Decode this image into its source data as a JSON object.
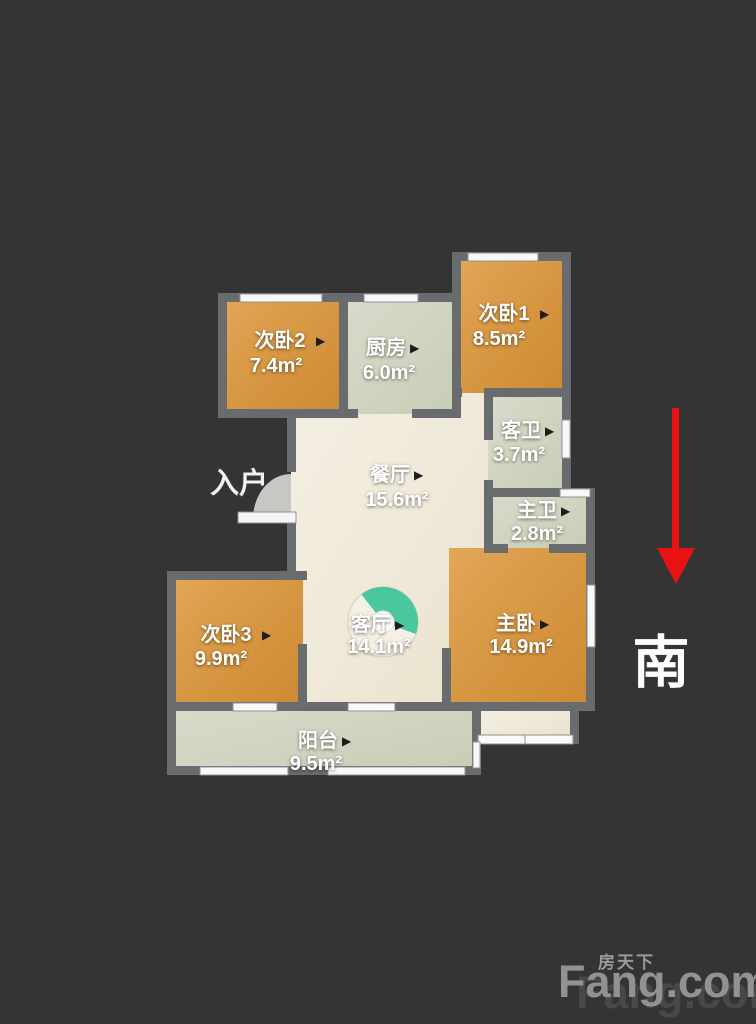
{
  "plan_title": "户型图",
  "marker_glyph": "▶",
  "entrance": {
    "label": "入户"
  },
  "compass": {
    "label": "南",
    "direction": "south",
    "arrow_color": "#e81212"
  },
  "rooms": [
    {
      "id": "bed1",
      "name": "次卧1",
      "area": "8.5m²"
    },
    {
      "id": "bed2",
      "name": "次卧2",
      "area": "7.4m²"
    },
    {
      "id": "kitchen",
      "name": "厨房",
      "area": "6.0m²"
    },
    {
      "id": "guest_bath",
      "name": "客卫",
      "area": "3.7m²"
    },
    {
      "id": "master_bath",
      "name": "主卫",
      "area": "2.8m²"
    },
    {
      "id": "dining",
      "name": "餐厅",
      "area": "15.6m²"
    },
    {
      "id": "living",
      "name": "客厅",
      "area": "14.1m²"
    },
    {
      "id": "master_bed",
      "name": "主卧",
      "area": "14.9m²"
    },
    {
      "id": "bed3",
      "name": "次卧3",
      "area": "9.9m²"
    },
    {
      "id": "balcony",
      "name": "阳台",
      "area": "9.5m²"
    }
  ],
  "watermark": {
    "brand_en": "Fang.com",
    "brand_cn": "房天下"
  },
  "colors": {
    "background": "#343434",
    "wall": "#696c6e",
    "bedroom_floor": "#d89a48",
    "kitchen_bath_floor": "#d2d5c4",
    "hall_floor": "#f1ebdb",
    "window": "#f8f8f8",
    "pie_accent": "#49c79e",
    "compass_arrow": "#e81212",
    "watermark_gray": "#929292"
  }
}
